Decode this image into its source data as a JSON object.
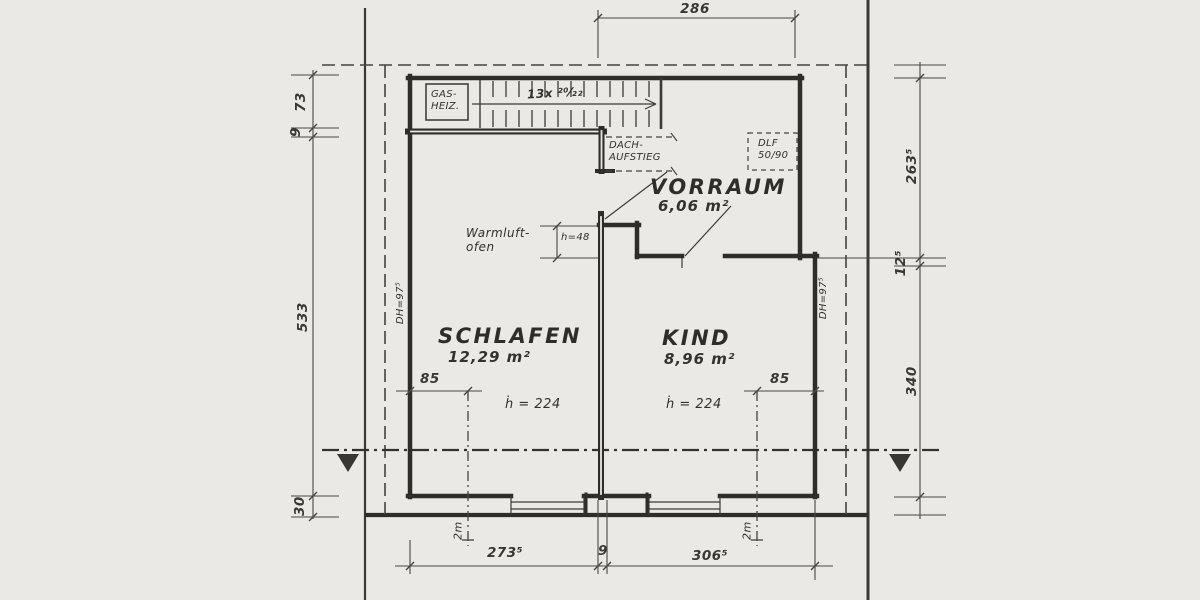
{
  "rooms": {
    "vorraum": {
      "name": "VORRAUM",
      "area": "6,06 m²"
    },
    "schlafen": {
      "name": "SCHLAFEN",
      "area": "12,29 m²",
      "height": "ḣ = 224"
    },
    "kind": {
      "name": "KIND",
      "area": "8,96 m²",
      "height": "ḣ = 224"
    }
  },
  "labels": {
    "gas_line1": "GAS-",
    "gas_line2": "HEIZ.",
    "stairs": "13x ²⁰⁄₂₂",
    "dach_line1": "DACH-",
    "dach_line2": "AUFSTIEG",
    "dlf_line1": "DLF",
    "dlf_line2": "50/90",
    "ofen_line1": "Warmluft-",
    "ofen_line2": "ofen",
    "h48": "h=48",
    "dh_left": "DH=97⁵",
    "dh_right": "DH=97⁵"
  },
  "dimensions": {
    "top": "286",
    "left_73": "73",
    "left_9": "9",
    "left_533": "533",
    "left_30": "30",
    "right_263": "263⁵",
    "right_12": "12⁵",
    "right_340": "340",
    "bottom_273": "273⁵",
    "bottom_9": "9",
    "bottom_306": "306⁵",
    "schlafen_85": "85",
    "kind_85": "85",
    "left_2m": "2m",
    "right_2m": "2m"
  },
  "colors": {
    "paper": "#ebe9e5",
    "wall_ink": "#32302c",
    "dim_ink": "#4a4741"
  }
}
